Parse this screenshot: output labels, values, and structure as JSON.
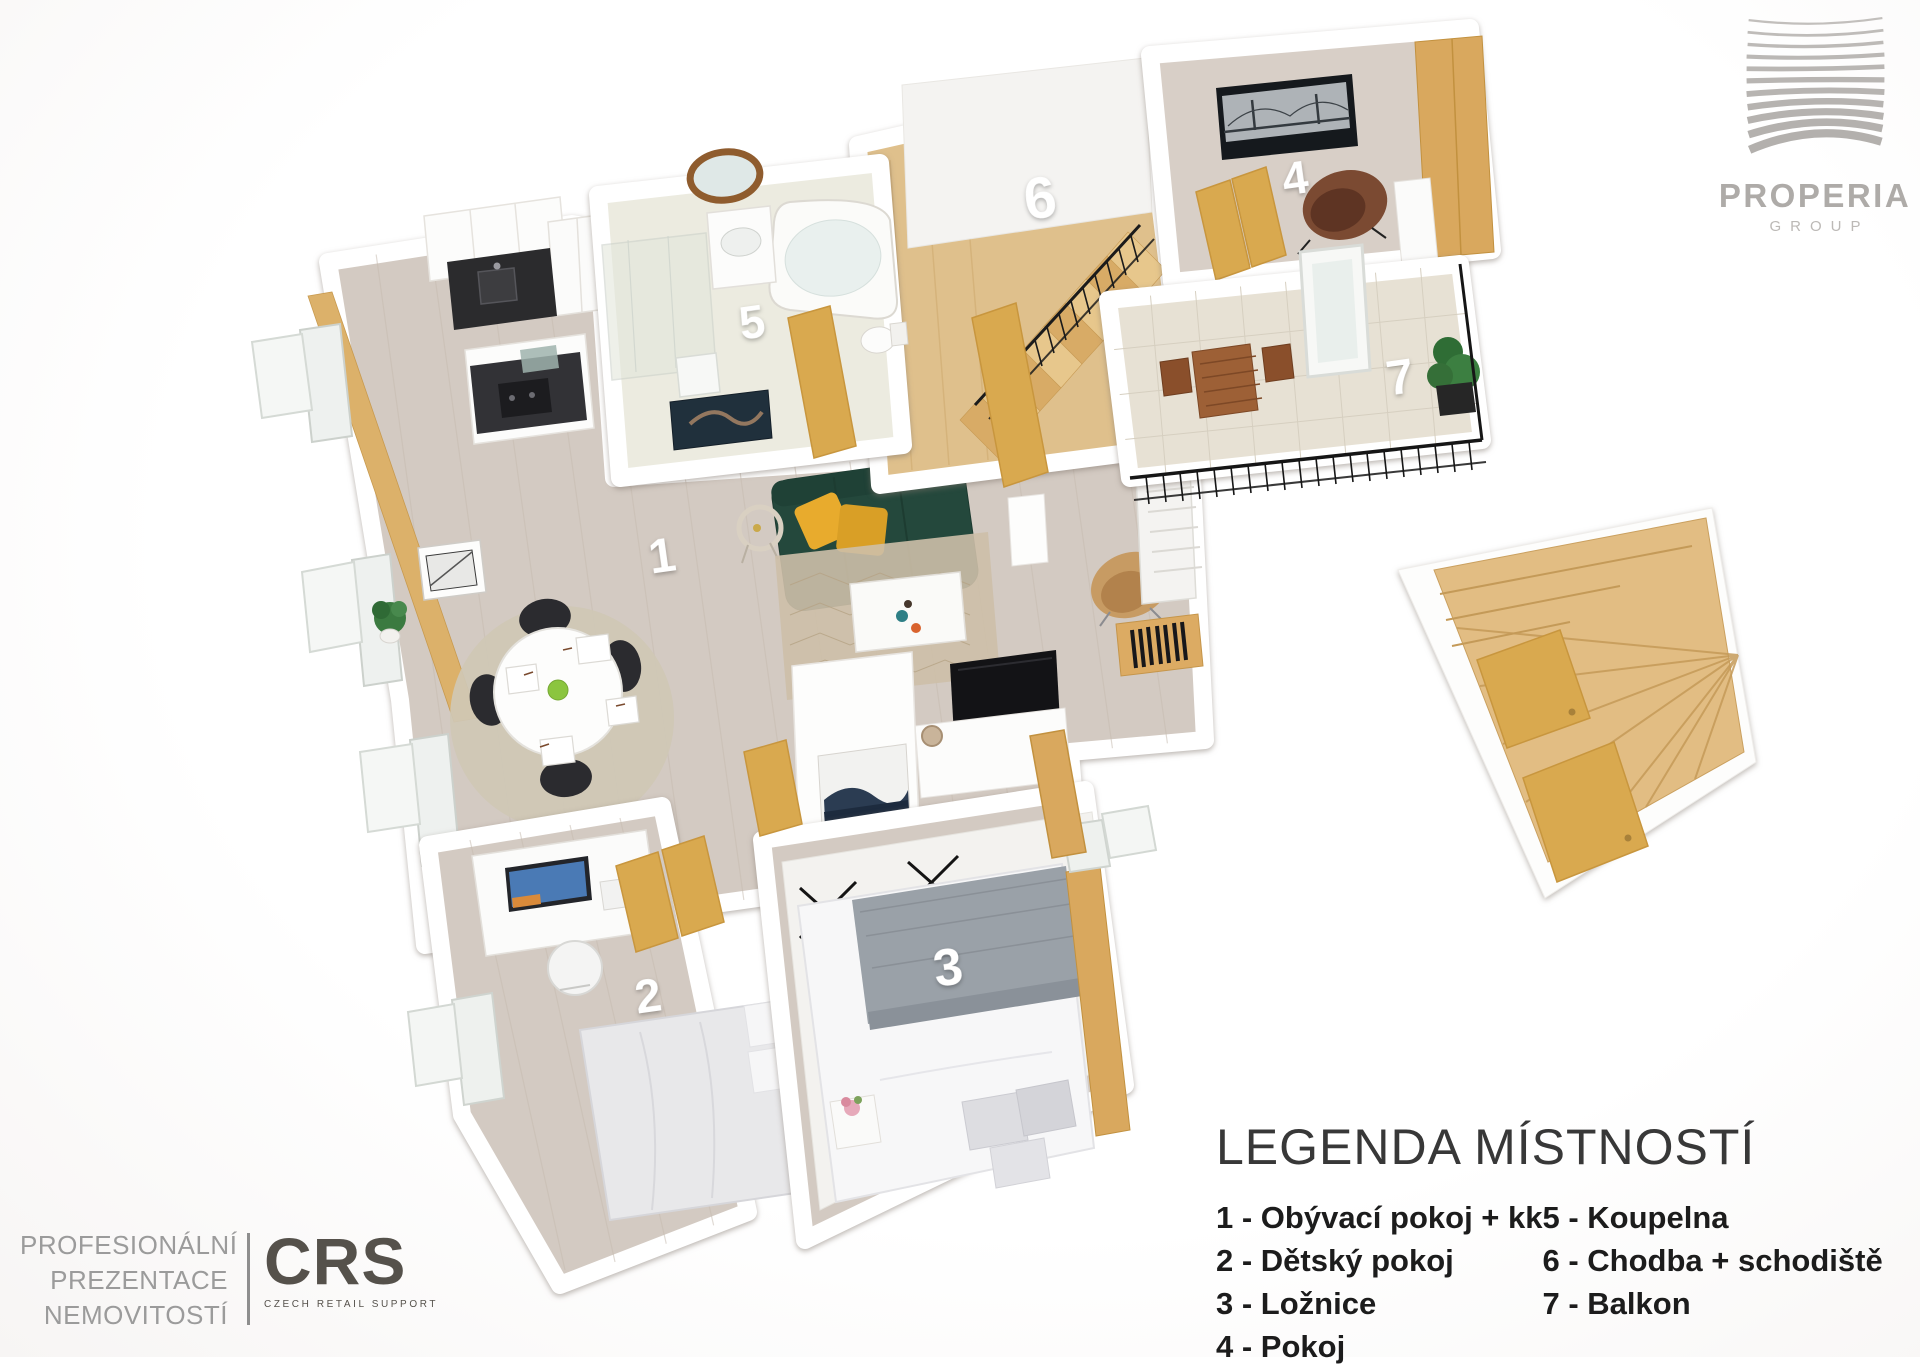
{
  "legend": {
    "title": "LEGENDA MÍSTNOSTÍ",
    "items": [
      {
        "number": "1",
        "name": "Obývací pokoj + kk",
        "label": "1 - Obývací pokoj + kk"
      },
      {
        "number": "2",
        "name": "Dětský pokoj",
        "label": "2 - Dětský pokoj"
      },
      {
        "number": "3",
        "name": "Ložnice",
        "label": "3 - Ložnice"
      },
      {
        "number": "4",
        "name": "Pokoj",
        "label": "4 - Pokoj"
      },
      {
        "number": "5",
        "name": "Koupelna",
        "label": "5 - Koupelna"
      },
      {
        "number": "6",
        "name": "Chodba + schodiště",
        "label": "6 - Chodba + schodiště"
      },
      {
        "number": "7",
        "name": "Balkon",
        "label": "7 - Balkon"
      }
    ]
  },
  "floorplan": {
    "rooms": [
      {
        "number": "1",
        "name": "Obývací pokoj + kk"
      },
      {
        "number": "2",
        "name": "Dětský pokoj"
      },
      {
        "number": "3",
        "name": "Ložnice"
      },
      {
        "number": "4",
        "name": "Pokoj"
      },
      {
        "number": "5",
        "name": "Koupelna"
      },
      {
        "number": "6",
        "name": "Chodba + schodiště"
      },
      {
        "number": "7",
        "name": "Balkon"
      }
    ],
    "colors": {
      "floor_wood": "#d3cac2",
      "floor_bath": "#ecebe0",
      "floor_balcony": "#e7e1d4",
      "floor_hall_oak": "#dfc08c",
      "stairs_oak": "#e2bd83",
      "door_oak": "#d9a94f",
      "sofa_green": "#24483c",
      "pillow_yellow": "#e8ab2d",
      "chair_tan": "#c79b63",
      "chair_brown": "#7b4a32",
      "railing_black": "#1b1b1b"
    }
  },
  "branding": {
    "properia": {
      "name": "PROPERIA",
      "subtitle": "GROUP"
    },
    "crs": {
      "tagline_lines": [
        "PROFESIONÁLNÍ",
        "PREZENTACE",
        "NEMOVITOSTÍ"
      ],
      "logo_text": "CRS",
      "logo_subtitle": "CZECH RETAIL SUPPORT"
    }
  }
}
